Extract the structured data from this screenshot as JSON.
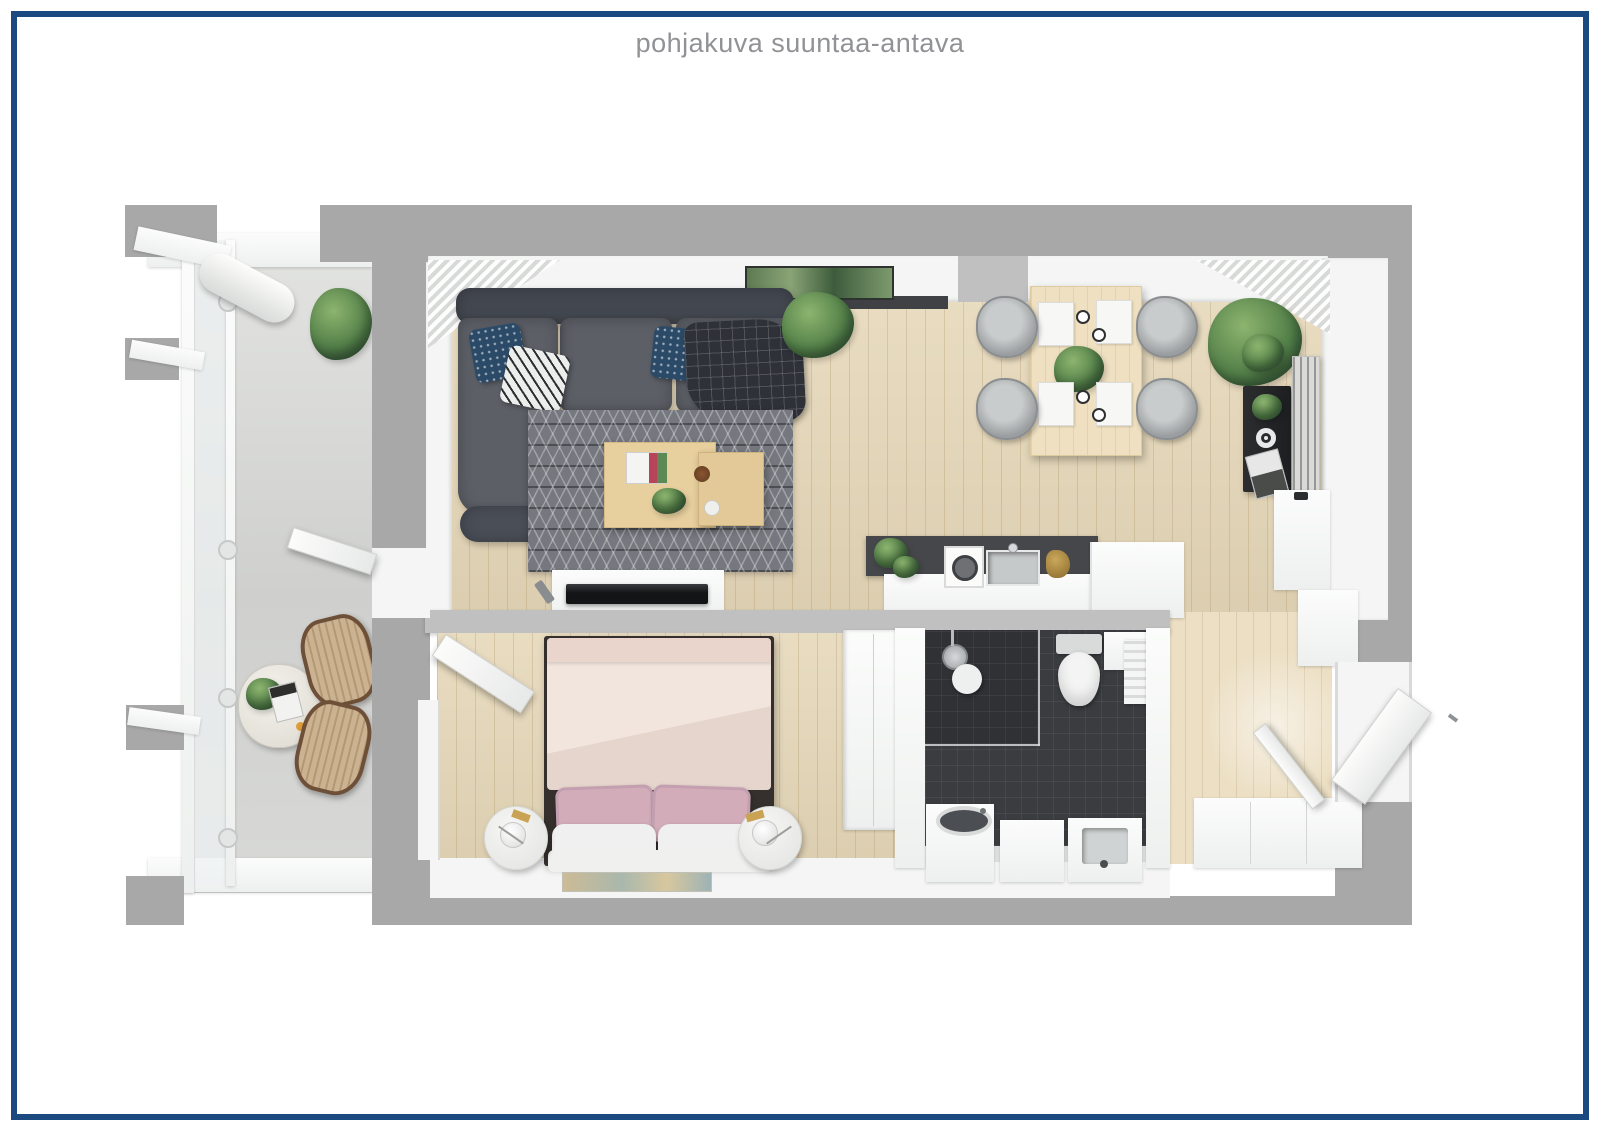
{
  "title": "pohjakuva suuntaa-antava",
  "colors": {
    "page_bg": "#ffffff",
    "frame_navy": "#1b4a80",
    "title_gray": "#909295",
    "wall_gray": "#a8a8a8",
    "wood_light": "#e6d8ba",
    "bath_tile": "#3a3c40",
    "sofa_gray": "#5c5f66",
    "rug_gray": "#75787e",
    "bed_blush": "#ecdfd8",
    "pillow_pink": "#d2adb9",
    "navy_pillow": "#2b4a67",
    "plant_green": "#55824a",
    "dining_table_wood": "#eee0c1",
    "counter_dark": "#45474a",
    "balcony_floor": "#d5d6d4"
  }
}
